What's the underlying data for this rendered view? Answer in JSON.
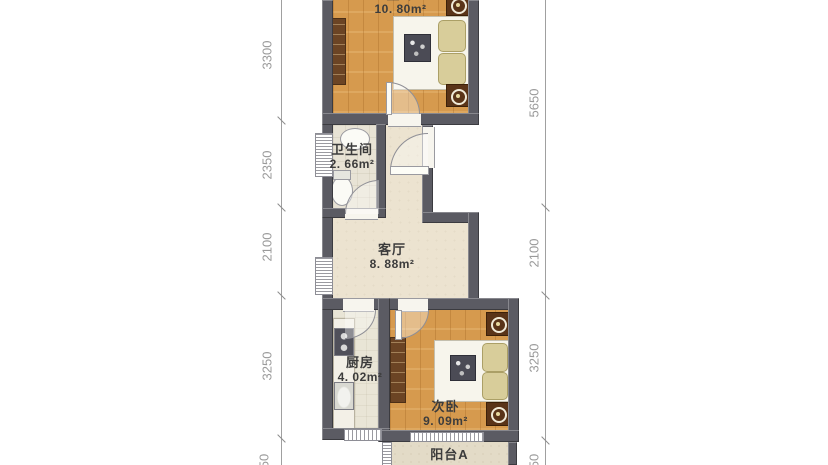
{
  "plan_type": "apartment-floor-plan",
  "rooms": [
    {
      "name": "主卧",
      "area": "10. 80m²"
    },
    {
      "name": "卫生间",
      "area": "2. 66m²"
    },
    {
      "name": "客厅",
      "area": "8. 88m²"
    },
    {
      "name": "厨房",
      "area": "4. 02m²"
    },
    {
      "name": "次卧",
      "area": "9. 09m²"
    },
    {
      "name": "阳台A",
      "area": ""
    }
  ],
  "dimensions": {
    "left": [
      "3300",
      "2350",
      "2100",
      "3250",
      "50"
    ],
    "right": [
      "5650",
      "2100",
      "3250",
      "50"
    ]
  },
  "colors": {
    "wall": "#5b5b63",
    "wood_floor": "#d69a4e",
    "living_floor": "#ece3d0",
    "bath_floor": "#e8e3d5",
    "kitchen_floor": "#e9e5d6",
    "balcony_floor": "#e3dbc7",
    "furniture_brown": "#6b4424",
    "dimension_gray": "#9a9a9a"
  }
}
